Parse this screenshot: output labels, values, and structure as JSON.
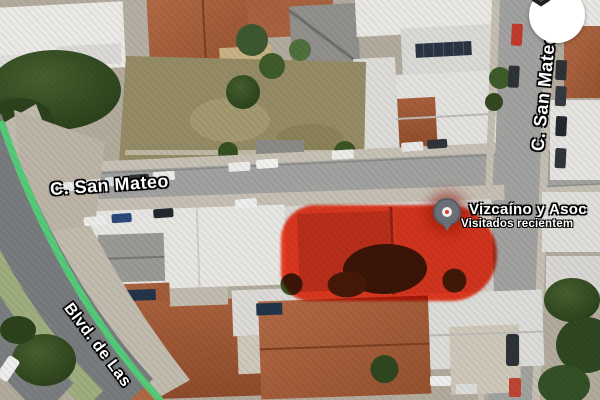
{
  "map": {
    "street_labels": {
      "san_mateo_horizontal": "C. San Mateo",
      "san_mateo_vertical": "C. San Mateo",
      "boulevard_partial": "Blvd. de Las"
    },
    "place": {
      "name": "Vizcaíno y Asoc",
      "status_line": "Visitados recientem"
    },
    "icons": {
      "layers_button": "layers-icon",
      "place_marker": "visited-place-pin-icon",
      "route_line": "green-route-line"
    },
    "colors": {
      "parcel_highlight": "#ff2000",
      "route_line_green": "#55cb79",
      "label_text": "#ffffff",
      "label_outline": "#000000",
      "layers_button_bg": "#ffffff",
      "layers_glyph": "#202124",
      "roof_terracotta": "#a8603c",
      "roof_white": "#e9e8e4",
      "road_gray": "#a2a2a0",
      "tree_green": "#33491f"
    }
  }
}
